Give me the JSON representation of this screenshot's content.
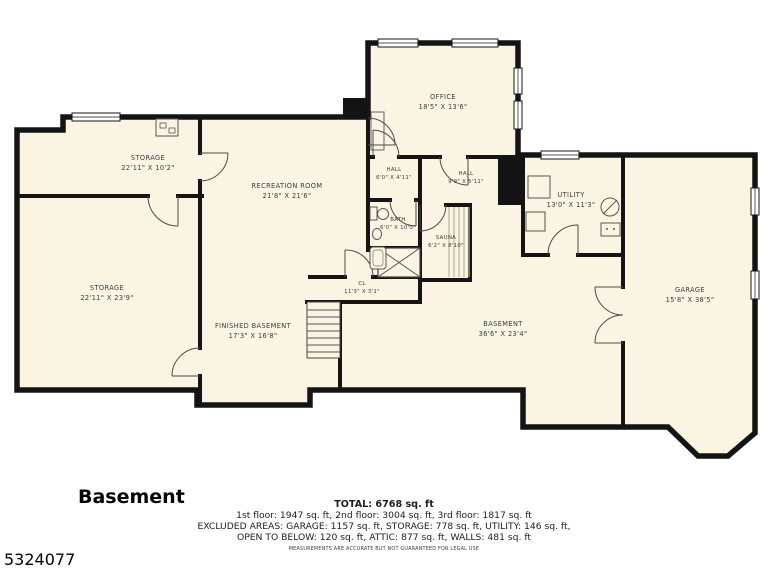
{
  "title": "Basement",
  "listing_id": "5324077",
  "rooms": {
    "storage_upper": {
      "name": "STORAGE",
      "dims": "22'11\" X 10'2\""
    },
    "storage_lower": {
      "name": "STORAGE",
      "dims": "22'11\" X 23'9\""
    },
    "recreation": {
      "name": "RECREATION ROOM",
      "dims": "21'8\" X 21'6\""
    },
    "office": {
      "name": "OFFICE",
      "dims": "18'5\" X 13'6\""
    },
    "hall_small": {
      "name": "HALL",
      "dims": "6'0\" X 4'11\""
    },
    "hall_main": {
      "name": "HALL",
      "dims": "9'9\" X 5'11\""
    },
    "bath": {
      "name": "BATH",
      "dims": "6'0\" X 10'0\""
    },
    "sauna": {
      "name": "SAUNA",
      "dims": "6'2\" X 8'10\""
    },
    "closet": {
      "name": "CL",
      "dims": "11'3\" X 3'1\""
    },
    "utility": {
      "name": "UTILITY",
      "dims": "13'0\" X 11'3\""
    },
    "basement": {
      "name": "BASEMENT",
      "dims": "36'6\" X 23'4\""
    },
    "finished_basement": {
      "name": "FINISHED BASEMENT",
      "dims": "17'3\" X 16'8\""
    },
    "garage": {
      "name": "GARAGE",
      "dims": "15'8\" X 38'5\""
    }
  },
  "summary": {
    "total": "TOTAL: 6768 sq. ft",
    "floors": "1st floor: 1947 sq. ft, 2nd floor: 3004 sq. ft, 3rd floor: 1817 sq. ft",
    "excluded1": "EXCLUDED AREAS: GARAGE: 1157 sq. ft, STORAGE: 778 sq. ft, UTILITY: 146 sq. ft,",
    "excluded2": "OPEN TO BELOW: 120 sq. ft, ATTIC: 877 sq. ft, WALLS: 481 sq. ft",
    "disclaimer": "MEASUREMENTS ARE ACCURATE BUT NOT GUARANTEED FOR LEGAL USE"
  },
  "colors": {
    "floor": "#faf5e3",
    "wall": "#141414"
  }
}
